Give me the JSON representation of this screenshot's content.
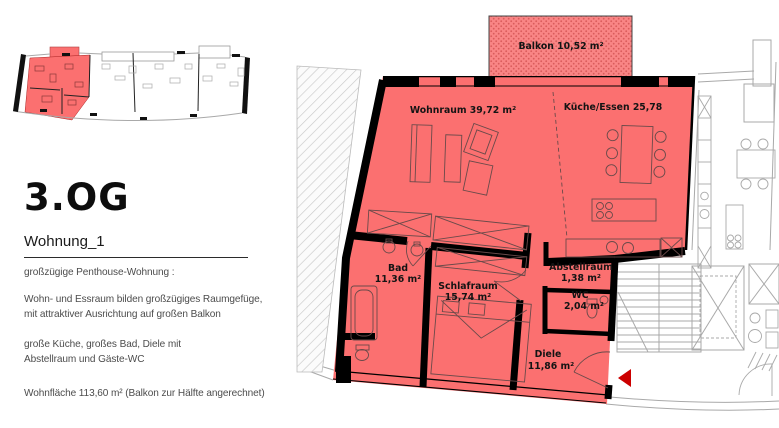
{
  "sidebar": {
    "floor_title": "3.OG",
    "apartment_title": "Wohnung_1",
    "description": [
      "großzügige Penthouse-Wohnung :",
      "Wohn- und Essraum bilden großzügiges Raumgefüge,",
      "mit attraktiver Ausrichtung auf großen Balkon",
      "große Küche, großes Bad, Diele mit",
      "Abstellraum und Gäste-WC"
    ],
    "area_summary": "Wohnfläche   113,60 m²  (Balkon zur Hälfte angerechnet)"
  },
  "floorplan": {
    "rooms": [
      {
        "name": "Balkon",
        "area": "10,52 m²",
        "label": "Balkon 10,52 m²"
      },
      {
        "name": "Wohnraum",
        "area": "39,72 m²",
        "label": "Wohnraum 39,72 m²"
      },
      {
        "name": "Küche/Essen",
        "area": "25,78",
        "label": "Küche/Essen 25,78"
      },
      {
        "name": "Bad",
        "area": "11,36 m²"
      },
      {
        "name": "Schlafraum",
        "area": "15,74 m²"
      },
      {
        "name": "Abstellraum",
        "area": "1,38 m²"
      },
      {
        "name": "WC",
        "area": "2,04 m²"
      },
      {
        "name": "Diele",
        "area": "11,86 m²"
      }
    ],
    "colors": {
      "highlight": "#fb7070",
      "balcony_dots": "#d95c5c",
      "wall": "#000000",
      "neighbor_lines": "#a9a9a9",
      "entrance_arrow": "#cc0000"
    }
  }
}
